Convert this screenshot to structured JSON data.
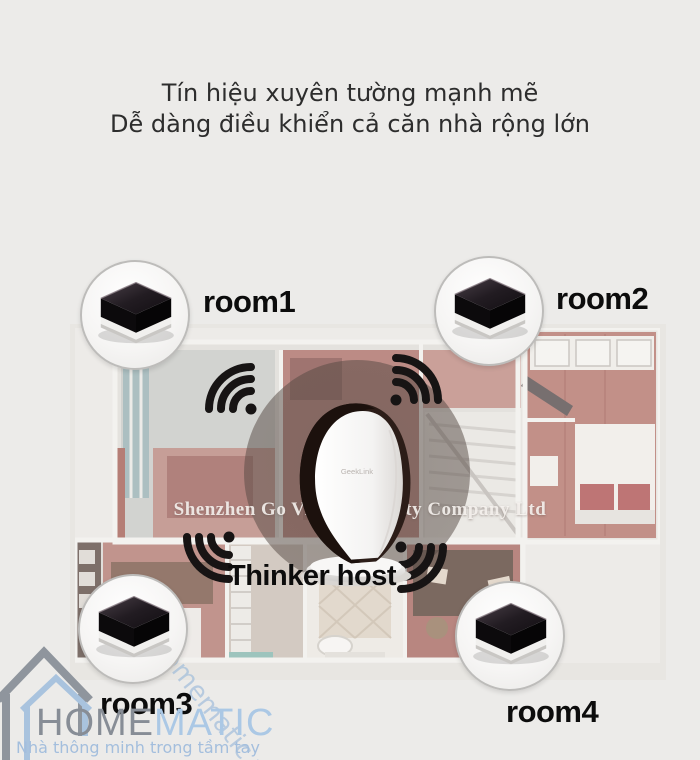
{
  "headline": {
    "line1": "Tín hiệu xuyên tường mạnh mẽ",
    "line2": "Dễ dàng điều khiển cả căn nhà rộng lớn"
  },
  "diagram": {
    "host_label": "Thinker host",
    "host_device_logo": "GeekLink",
    "company_watermark": "Shenzhen Go Vision Security Company Ltd",
    "rooms": [
      {
        "label": "room1"
      },
      {
        "label": "room2"
      },
      {
        "label": "room3"
      },
      {
        "label": "room4"
      }
    ]
  },
  "branding": {
    "name_part1": "HOME",
    "name_part2": "MATIC",
    "tagline": "Nhà thông minh trong tầm tay",
    "site_watermark": "www.homematic.vn"
  },
  "icons": {
    "wifi": "wifi-signal-icon",
    "house": "house-outline-icon"
  },
  "colors": {
    "brand_gray": "#878d96",
    "brand_blue": "#abc8e5",
    "wifi_black": "#171414",
    "floor_red": "#a5625a",
    "background": "#ecebe9"
  }
}
